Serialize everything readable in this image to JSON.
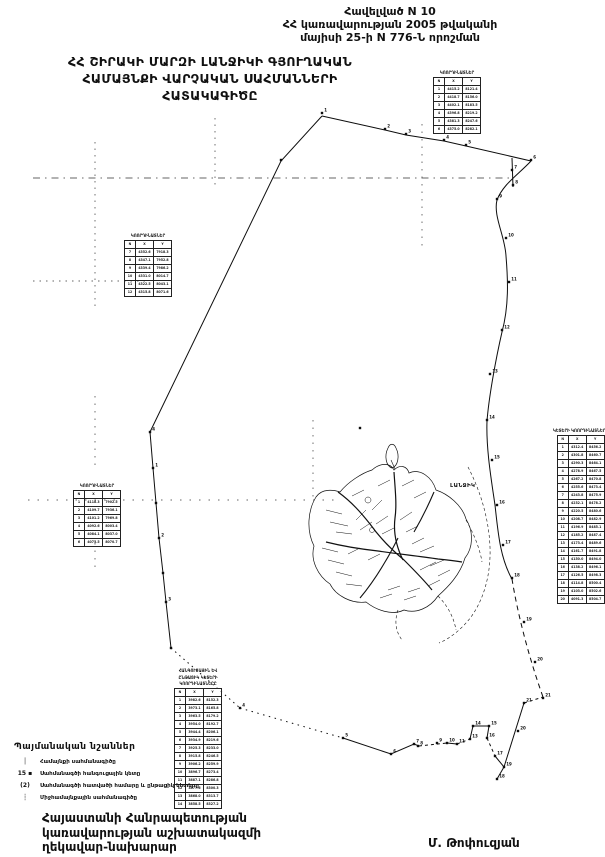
{
  "page": {
    "bg": "#ffffff",
    "ink": "#111111"
  },
  "header": {
    "lines": [
      "Հավելված N 10",
      "ՀՀ կառավարության 2005 թվականի",
      "մայիսի 25-ի N 776-Ն որոշման"
    ]
  },
  "title": {
    "lines": [
      "ՀՀ ՇԻՐԱԿԻ ՄԱՐԶԻ ԼԱՆՋԻԿԻ ԳՅՈՒՂԱԿԱՆ",
      "ՀԱՄԱՅՆՔԻ ՎԱՐՉԱԿԱՆ ՍԱՀՄԱՆՆԵՐԻ",
      "ՀԱՏԱԿԱԳԻԾԸ"
    ]
  },
  "map": {
    "settlement_label": "ԼԱՆՋԻԿ",
    "points": [
      [
        322,
        113,
        "1"
      ],
      [
        385,
        129,
        "2"
      ],
      [
        406,
        134,
        "3"
      ],
      [
        444,
        140,
        "4"
      ],
      [
        466,
        145,
        "5"
      ],
      [
        531,
        160,
        "6"
      ],
      [
        512,
        170,
        "7"
      ],
      [
        513,
        185,
        "8"
      ],
      [
        497,
        199,
        "9"
      ],
      [
        506,
        238,
        "10"
      ],
      [
        509,
        282,
        "11"
      ],
      [
        502,
        330,
        "12"
      ],
      [
        490,
        374,
        "13"
      ],
      [
        487,
        420,
        "14"
      ],
      [
        492,
        460,
        "15"
      ],
      [
        497,
        505,
        "16"
      ],
      [
        503,
        545,
        "17"
      ],
      [
        512,
        578,
        "18"
      ],
      [
        524,
        622,
        "19"
      ],
      [
        535,
        662,
        "20"
      ],
      [
        543,
        698,
        "21"
      ],
      [
        281,
        160,
        ""
      ],
      [
        150,
        432,
        "4"
      ],
      [
        153,
        468,
        "1"
      ],
      [
        156,
        503,
        ""
      ],
      [
        159,
        538,
        "2"
      ],
      [
        163,
        573,
        ""
      ],
      [
        166,
        602,
        "3"
      ],
      [
        171,
        648,
        ""
      ],
      [
        240,
        708,
        "4"
      ],
      [
        343,
        738,
        "5"
      ],
      [
        391,
        754,
        "6"
      ],
      [
        414,
        744,
        "7"
      ],
      [
        418,
        746,
        "8"
      ],
      [
        437,
        743,
        "9"
      ],
      [
        447,
        743,
        "10"
      ],
      [
        457,
        744,
        "11"
      ],
      [
        470,
        739,
        "13"
      ],
      [
        473,
        726,
        "14"
      ],
      [
        489,
        726,
        "15"
      ],
      [
        487,
        738,
        "16"
      ],
      [
        495,
        756,
        "17"
      ],
      [
        504,
        767,
        "19"
      ],
      [
        497,
        779,
        "18"
      ],
      [
        518,
        731,
        "20"
      ],
      [
        524,
        703,
        "21"
      ],
      [
        360,
        428,
        ""
      ]
    ]
  },
  "tables": [
    {
      "header_lines": [
        "ԿՈՈՐԴԻՆԱՏՆԵՐ"
      ],
      "cols": [
        "N",
        "X",
        "Y"
      ],
      "rows": [
        [
          "1",
          "4415.2",
          "8121.4"
        ],
        [
          "2",
          "4418.7",
          "8156.0"
        ],
        [
          "3",
          "4402.1",
          "8183.5"
        ],
        [
          "4",
          "4396.8",
          "8219.2"
        ],
        [
          "5",
          "4381.3",
          "8247.6"
        ],
        [
          "6",
          "4375.0",
          "8282.1"
        ]
      ]
    },
    {
      "header_lines": [
        "ԿՈՈՐԴԻՆԱՏՆԵՐ"
      ],
      "cols": [
        "N",
        "X",
        "Y"
      ],
      "rows": [
        [
          "7",
          "4352.6",
          "7918.3"
        ],
        [
          "8",
          "4347.1",
          "7952.8"
        ],
        [
          "9",
          "4339.4",
          "7986.2"
        ],
        [
          "10",
          "4331.0",
          "8014.7"
        ],
        [
          "11",
          "4322.5",
          "8043.1"
        ],
        [
          "12",
          "4315.8",
          "8071.6"
        ]
      ]
    },
    {
      "header_lines": [
        "ԿՈՈՐԴԻՆԱՏՆԵՐ"
      ],
      "cols": [
        "N",
        "X",
        "Y"
      ],
      "rows": [
        [
          "1",
          "4118.3",
          "7902.5"
        ],
        [
          "2",
          "4109.7",
          "7936.1"
        ],
        [
          "3",
          "4101.2",
          "7969.8"
        ],
        [
          "4",
          "4092.6",
          "8003.4"
        ],
        [
          "5",
          "4084.1",
          "8037.0"
        ],
        [
          "6",
          "4075.5",
          "8070.7"
        ]
      ]
    },
    {
      "header_lines": [
        "ԿԵՏԵՐԻ ԿՈՈՐԴԻՆԱՏՆԵՐԸ"
      ],
      "cols": [
        "N",
        "X",
        "Y"
      ],
      "rows": [
        [
          "1",
          "4312.4",
          "8456.2"
        ],
        [
          "2",
          "4301.8",
          "8460.7"
        ],
        [
          "3",
          "4290.3",
          "8464.1"
        ],
        [
          "4",
          "4278.9",
          "8467.5"
        ],
        [
          "5",
          "4267.2",
          "8470.8"
        ],
        [
          "6",
          "4255.6",
          "8473.4"
        ],
        [
          "7",
          "4243.8",
          "8475.9"
        ],
        [
          "8",
          "4232.1",
          "8478.2"
        ],
        [
          "9",
          "4220.5",
          "8480.6"
        ],
        [
          "10",
          "4208.7",
          "8482.9"
        ],
        [
          "11",
          "4196.9",
          "8485.1"
        ],
        [
          "12",
          "4185.2",
          "8487.4"
        ],
        [
          "13",
          "4173.4",
          "8489.6"
        ],
        [
          "14",
          "4161.7",
          "8491.8"
        ],
        [
          "15",
          "4150.0",
          "8494.0"
        ],
        [
          "16",
          "4138.2",
          "8496.1"
        ],
        [
          "17",
          "4126.5",
          "8498.3"
        ],
        [
          "18",
          "4114.8",
          "8500.4"
        ],
        [
          "19",
          "4103.0",
          "8502.6"
        ],
        [
          "20",
          "4091.3",
          "8504.7"
        ]
      ]
    },
    {
      "header_lines": [
        "ՀԱՆԳՈՒՑԱՅԻՆ ԵՎ",
        "ԸՆԹԱՑԻԿ ԿԵՏԵՐԻ",
        "ԿՈՈՐԴԻՆԱՏՆԵՐԸ"
      ],
      "cols": [
        "N",
        "X",
        "Y"
      ],
      "rows": [
        [
          "1",
          "3982.6",
          "8152.3"
        ],
        [
          "2",
          "3973.1",
          "8165.8"
        ],
        [
          "3",
          "3963.5",
          "8179.2"
        ],
        [
          "4",
          "3954.0",
          "8192.7"
        ],
        [
          "5",
          "3944.4",
          "8206.1"
        ],
        [
          "6",
          "3934.9",
          "8219.6"
        ],
        [
          "7",
          "3925.3",
          "8233.0"
        ],
        [
          "8",
          "3915.8",
          "8246.5"
        ],
        [
          "9",
          "3906.2",
          "8259.9"
        ],
        [
          "10",
          "3896.7",
          "8273.4"
        ],
        [
          "11",
          "3887.1",
          "8286.8"
        ],
        [
          "12",
          "3877.6",
          "8300.3"
        ],
        [
          "13",
          "3868.0",
          "8313.7"
        ],
        [
          "14",
          "3858.5",
          "8327.2"
        ]
      ]
    }
  ],
  "legend": {
    "title": "Պայմանական նշաններ",
    "items": [
      {
        "symbol": "│",
        "label": "Համայնքի սահմանագիծը"
      },
      {
        "symbol": "15 ▪",
        "label": "Սահմանագծի հանգուցային կետը"
      },
      {
        "symbol": "(2)",
        "label": "Սահմանագծի հատվածի համարը և ընթացիկ կետերը"
      },
      {
        "symbol": "┆",
        "label": "Միջհամայնքային սահմանագիծը"
      }
    ]
  },
  "footer": {
    "lines": [
      "Հայաստանի Հանրապետության",
      "կառավարության աշխատակազմի",
      "ղեկավար-նախարար"
    ],
    "signer": "Մ. Թոփուզյան"
  }
}
